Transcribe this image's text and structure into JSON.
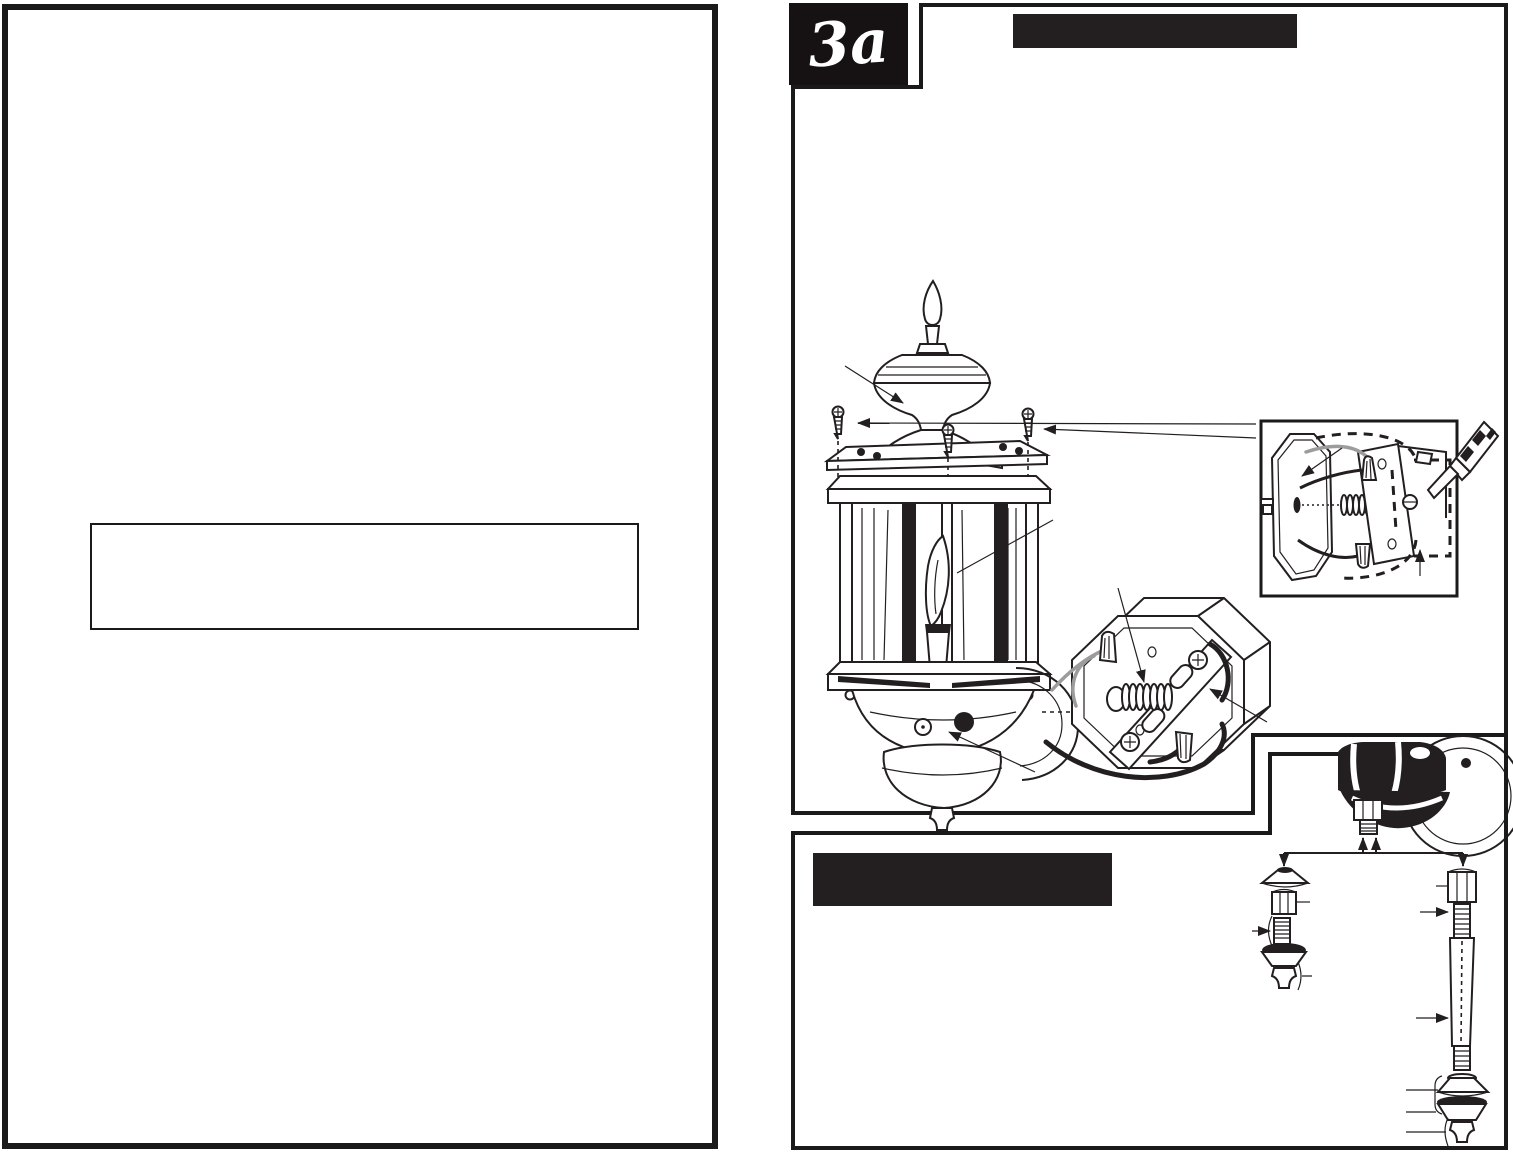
{
  "document": {
    "step_badge": "3a",
    "header_bar_text": "",
    "subheader_bar_text": "",
    "note_box_text": "",
    "left_page_text": ""
  },
  "colors": {
    "ink": "#231f20",
    "paper": "#ffffff",
    "bar": "#231f20"
  },
  "figures": {
    "main_diagram": "exploded-wall-lantern-assembly",
    "inset_diagram": "junction-box-wiring-detail",
    "parts_diagram": "stem-and-finial-hardware-options"
  }
}
